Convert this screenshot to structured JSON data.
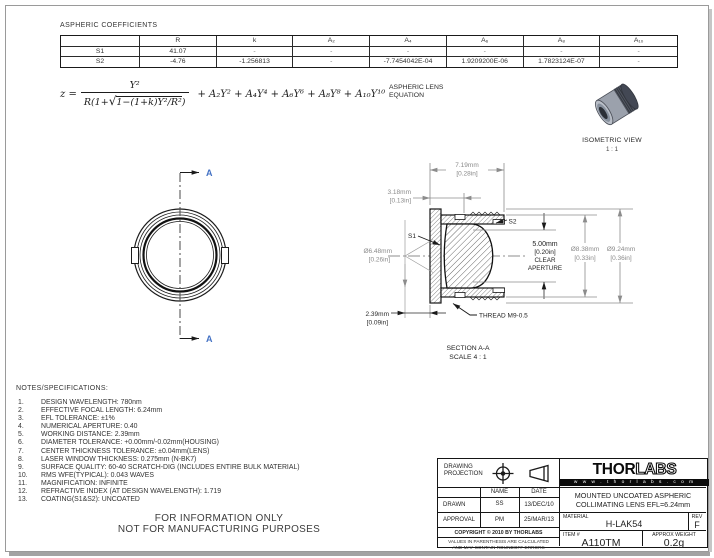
{
  "coefficients": {
    "title": "ASPHERIC COEFFICIENTS",
    "headers": [
      "",
      "R",
      "k",
      "A₂",
      "A₄",
      "A₆",
      "A₈",
      "A₁₀"
    ],
    "rows": [
      {
        "cells": [
          "S1",
          "41.07",
          "-",
          "-",
          "-",
          "-",
          "-",
          "-"
        ]
      },
      {
        "cells": [
          "S2",
          "-4.76",
          "-1.256813",
          "-",
          "-7.7454042E-04",
          "1.9209200E-06",
          "1.7823124E-07",
          "-"
        ]
      }
    ]
  },
  "equation": {
    "lhs": "z =",
    "numerator": "Y²",
    "den_prefix": "R(1+",
    "radical": "√",
    "radicand": "1−(1+k)Y²/R²",
    "den_suffix": ")",
    "tail": "+ A₂Y² + A₄Y⁴ + A₆Y⁶ + A₈Y⁸ + A₁₀Y¹⁰",
    "label_line1": "ASPHERIC LENS",
    "label_line2": "EQUATION"
  },
  "iso_view": {
    "caption": "ISOMETRIC VIEW",
    "scale": "1 : 1"
  },
  "front_view": {
    "section_label": "A"
  },
  "section_view": {
    "dim719a": "7.19mm",
    "dim719b": "[0.28in]",
    "dim318a": "3.18mm",
    "dim318b": "[0.13in]",
    "dim648a": "Ø6.48mm",
    "dim648b": "[0.26in]",
    "dim239a": "2.39mm",
    "dim239b": "[0.09in]",
    "ca1": "5.00mm",
    "ca2": "[0.20in]",
    "ca3": "CLEAR",
    "ca4": "APERTURE",
    "dim838a": "Ø8.38mm",
    "dim838b": "[0.33in]",
    "dim924a": "Ø9.24mm",
    "dim924b": "[0.36in]",
    "s1": "S1",
    "s2": "S2",
    "thread": "THREAD M9-0.5",
    "cap1": "SECTION A-A",
    "cap2": "SCALE 4 : 1"
  },
  "notes": {
    "heading": "NOTES/SPECIFICATIONS:",
    "items": [
      {
        "num": "1.",
        "text": "DESIGN WAVELENGTH: 780nm"
      },
      {
        "num": "2.",
        "text": "EFFECTIVE FOCAL LENGTH: 6.24mm"
      },
      {
        "num": "3.",
        "text": "EFL TOLERANCE:  ±1%"
      },
      {
        "num": "4.",
        "text": "NUMERICAL APERTURE: 0.40"
      },
      {
        "num": "5.",
        "text": "WORKING DISTANCE: 2.39mm"
      },
      {
        "num": "6.",
        "text": "DIAMETER TOLERANCE: +0.00mm/-0.02mm(HOUSING)"
      },
      {
        "num": "7.",
        "text": "CENTER THICKNESS TOLERANCE:  ±0.04mm(LENS)"
      },
      {
        "num": "8.",
        "text": "LASER WINDOW THICKNESS: 0.275mm (N-BK7)"
      },
      {
        "num": "9.",
        "text": "SURFACE QUALITY: 60-40 SCRATCH-DIG (INCLUDES ENTIRE BULK MATERIAL)"
      },
      {
        "num": "10.",
        "text": "RMS WFE(TYPICAL): 0.043 WAVES"
      },
      {
        "num": "11.",
        "text": "MAGNIFICATION: INFINITE"
      },
      {
        "num": "12.",
        "text": "REFRACTIVE INDEX (AT DESIGN WAVELENGTH): 1.719"
      },
      {
        "num": "13.",
        "text": "COATING(S1&S2): UNCOATED"
      }
    ]
  },
  "footer": {
    "line1": "FOR INFORMATION ONLY",
    "line2": "NOT FOR MANUFACTURING PURPOSES"
  },
  "title_block": {
    "projection_label1": "DRAWING",
    "projection_label2": "PROJECTION",
    "name_header": "NAME",
    "date_header": "DATE",
    "drawn_label": "DRAWN",
    "drawn_name": "SS",
    "drawn_date": "13/DEC/10",
    "approval_label": "APPROVAL",
    "approval_name": "PM",
    "approval_date": "25/MAR/13",
    "copyright": "COPYRIGHT © 2010 BY THORLABS",
    "disclaimer1": "VALUES IN PARENTHESIS ARE CALCULATED",
    "disclaimer2": "AND MAY CONTAIN ROUNDOFF ERRORS",
    "logo_thor": "THOR",
    "logo_labs": "LABS",
    "logo_url": "w w w . t h o r l a b s . c o m",
    "product_line1": "MOUNTED UNCOATED ASPHERIC",
    "product_line2": "COLLIMATING LENS  EFL=6.24mm",
    "material_label": "MATERIAL",
    "material": "H-LAK54",
    "rev_label": "REV",
    "rev": "F",
    "item_label": "ITEM #",
    "item": "A110TM",
    "weight_label": "APPROX WEIGHT",
    "weight": "0.2g"
  }
}
